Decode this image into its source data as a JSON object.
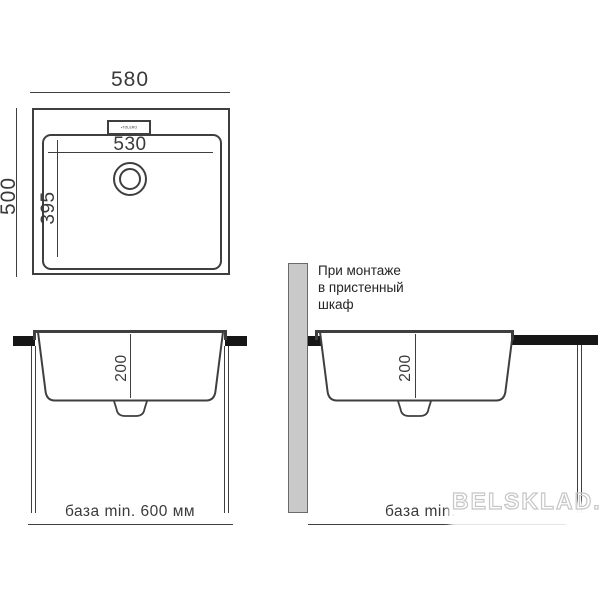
{
  "colors": {
    "line": "#3f3f3f",
    "countertop_black": "#161616",
    "wall_gray": "#c9c9c9",
    "watermark_gray": "#c6c6c6",
    "background": "#ffffff"
  },
  "top_view": {
    "overall_width": "580",
    "overall_depth": "500",
    "bowl_width": "530",
    "bowl_depth": "395",
    "logo": "▪TOLERO"
  },
  "front_view_left": {
    "bowl_height": "200",
    "base_note": "база min. 600 мм"
  },
  "front_view_right": {
    "bowl_height": "200",
    "base_note": "база min.",
    "mount_note_line1": "При монтаже",
    "mount_note_line2": "в пристенный",
    "mount_note_line3": "шкаф"
  },
  "watermark": {
    "text": "BELSKLAD.bg"
  }
}
